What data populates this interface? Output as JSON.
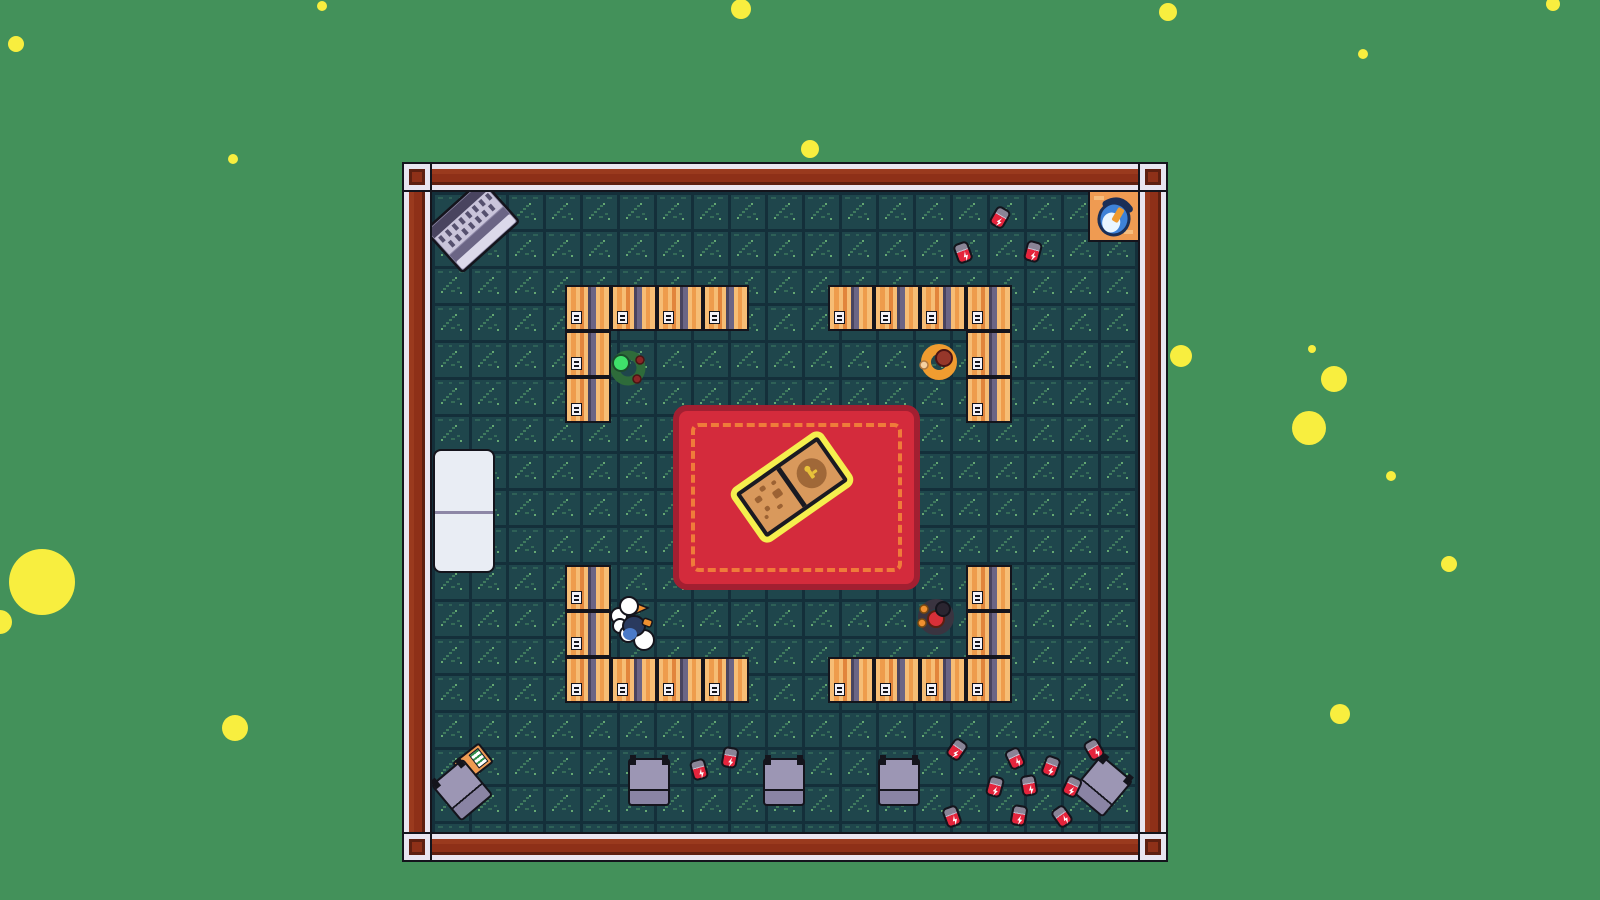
{
  "meta": {
    "scene_label": "Top-down pixel-art room with desks, carpet, glowing book, characters and scattered soda cans"
  },
  "colors": {
    "bg-green": "#43915a",
    "particle-yellow": "#f8ee3f",
    "outline": "#14141c",
    "wall-red": "#8e3018",
    "wall-red-hi": "#9a3a1e",
    "wall-red-dark": "#5e1f10",
    "wall-white": "#e9e5f0",
    "floor-base": "#1f464c",
    "floor-grid": "#142f3a",
    "floor-mark": "#3f7a5e",
    "desk-light": "#f6bd75",
    "desk-mid": "#ee9c4c",
    "desk-dark": "#e2853c",
    "desk-purple": "#6b6585",
    "desk-purple-dark": "#49445f",
    "carpet-red": "#d42b3c",
    "carpet-edge": "#a21f31",
    "carpet-stitch": "#ef7b3a",
    "book-glow": "#f5ef4e",
    "page-tan": "#d9995c",
    "page-spot": "#9c6233",
    "white-obj": "#e9edf4",
    "chair-gray": "#9c96b4",
    "chair-band": "#8a84a4",
    "can-red": "#e5243c",
    "can-top": "#8a8496"
  },
  "room": {
    "x": 402,
    "y": 162,
    "w": 766,
    "h": 700,
    "wall": 30
  },
  "carpet": {
    "x": 673,
    "y": 405,
    "w": 247,
    "h": 185
  },
  "book": {
    "x": 707,
    "y": 412,
    "rot": -35
  },
  "piano": {
    "x": 425,
    "y": 182,
    "rot": -42
  },
  "cabinet": {
    "x": 433,
    "y": 449,
    "w": 62,
    "h": 124
  },
  "bucket_station": {
    "x": 1088,
    "y": 190
  },
  "booklet": {
    "x": 456,
    "y": 750,
    "rot": -38
  },
  "desks": [
    [
      565,
      285
    ],
    [
      611,
      285
    ],
    [
      657,
      285
    ],
    [
      703,
      285
    ],
    [
      565,
      331
    ],
    [
      565,
      377
    ],
    [
      828,
      285
    ],
    [
      874,
      285
    ],
    [
      920,
      285
    ],
    [
      966,
      285
    ],
    [
      966,
      331
    ],
    [
      966,
      377
    ],
    [
      565,
      565
    ],
    [
      565,
      611
    ],
    [
      565,
      657
    ],
    [
      611,
      657
    ],
    [
      657,
      657
    ],
    [
      703,
      657
    ],
    [
      966,
      565
    ],
    [
      966,
      611
    ],
    [
      828,
      657
    ],
    [
      874,
      657
    ],
    [
      920,
      657
    ],
    [
      966,
      657
    ]
  ],
  "chairs": [
    {
      "x": 628,
      "y": 758,
      "rot": 0
    },
    {
      "x": 763,
      "y": 758,
      "rot": 0
    },
    {
      "x": 878,
      "y": 758,
      "rot": 0
    },
    {
      "x": 441,
      "y": 766,
      "rot": -40
    },
    {
      "x": 1081,
      "y": 762,
      "rot": 40
    }
  ],
  "cans": [
    [
      1000,
      217,
      30
    ],
    [
      963,
      252,
      -20
    ],
    [
      1033,
      251,
      15
    ],
    [
      699,
      769,
      -15
    ],
    [
      730,
      757,
      10
    ],
    [
      957,
      749,
      35
    ],
    [
      1015,
      758,
      -25
    ],
    [
      1051,
      766,
      20
    ],
    [
      1094,
      749,
      -30
    ],
    [
      995,
      786,
      15
    ],
    [
      1029,
      785,
      -10
    ],
    [
      1072,
      786,
      25
    ],
    [
      952,
      816,
      -20
    ],
    [
      1019,
      815,
      10
    ],
    [
      1062,
      816,
      -35
    ]
  ],
  "characters": [
    {
      "name": "green-creature-character",
      "x": 604,
      "y": 342
    },
    {
      "name": "orange-creature-character",
      "x": 915,
      "y": 336
    },
    {
      "name": "goose-character",
      "x": 608,
      "y": 594
    },
    {
      "name": "shadow-creature-character",
      "x": 911,
      "y": 590
    }
  ],
  "particles": [
    [
      741,
      9,
      10
    ],
    [
      322,
      6,
      5
    ],
    [
      1168,
      12,
      9
    ],
    [
      1553,
      4,
      7
    ],
    [
      16,
      44,
      8
    ],
    [
      1363,
      54,
      5
    ],
    [
      233,
      159,
      5
    ],
    [
      810,
      149,
      9
    ],
    [
      1181,
      356,
      11
    ],
    [
      1312,
      349,
      4
    ],
    [
      1334,
      379,
      13
    ],
    [
      1309,
      428,
      17
    ],
    [
      1391,
      476,
      5
    ],
    [
      42,
      582,
      33
    ],
    [
      0,
      622,
      12
    ],
    [
      235,
      728,
      13
    ],
    [
      1449,
      564,
      8
    ],
    [
      1340,
      714,
      10
    ]
  ]
}
